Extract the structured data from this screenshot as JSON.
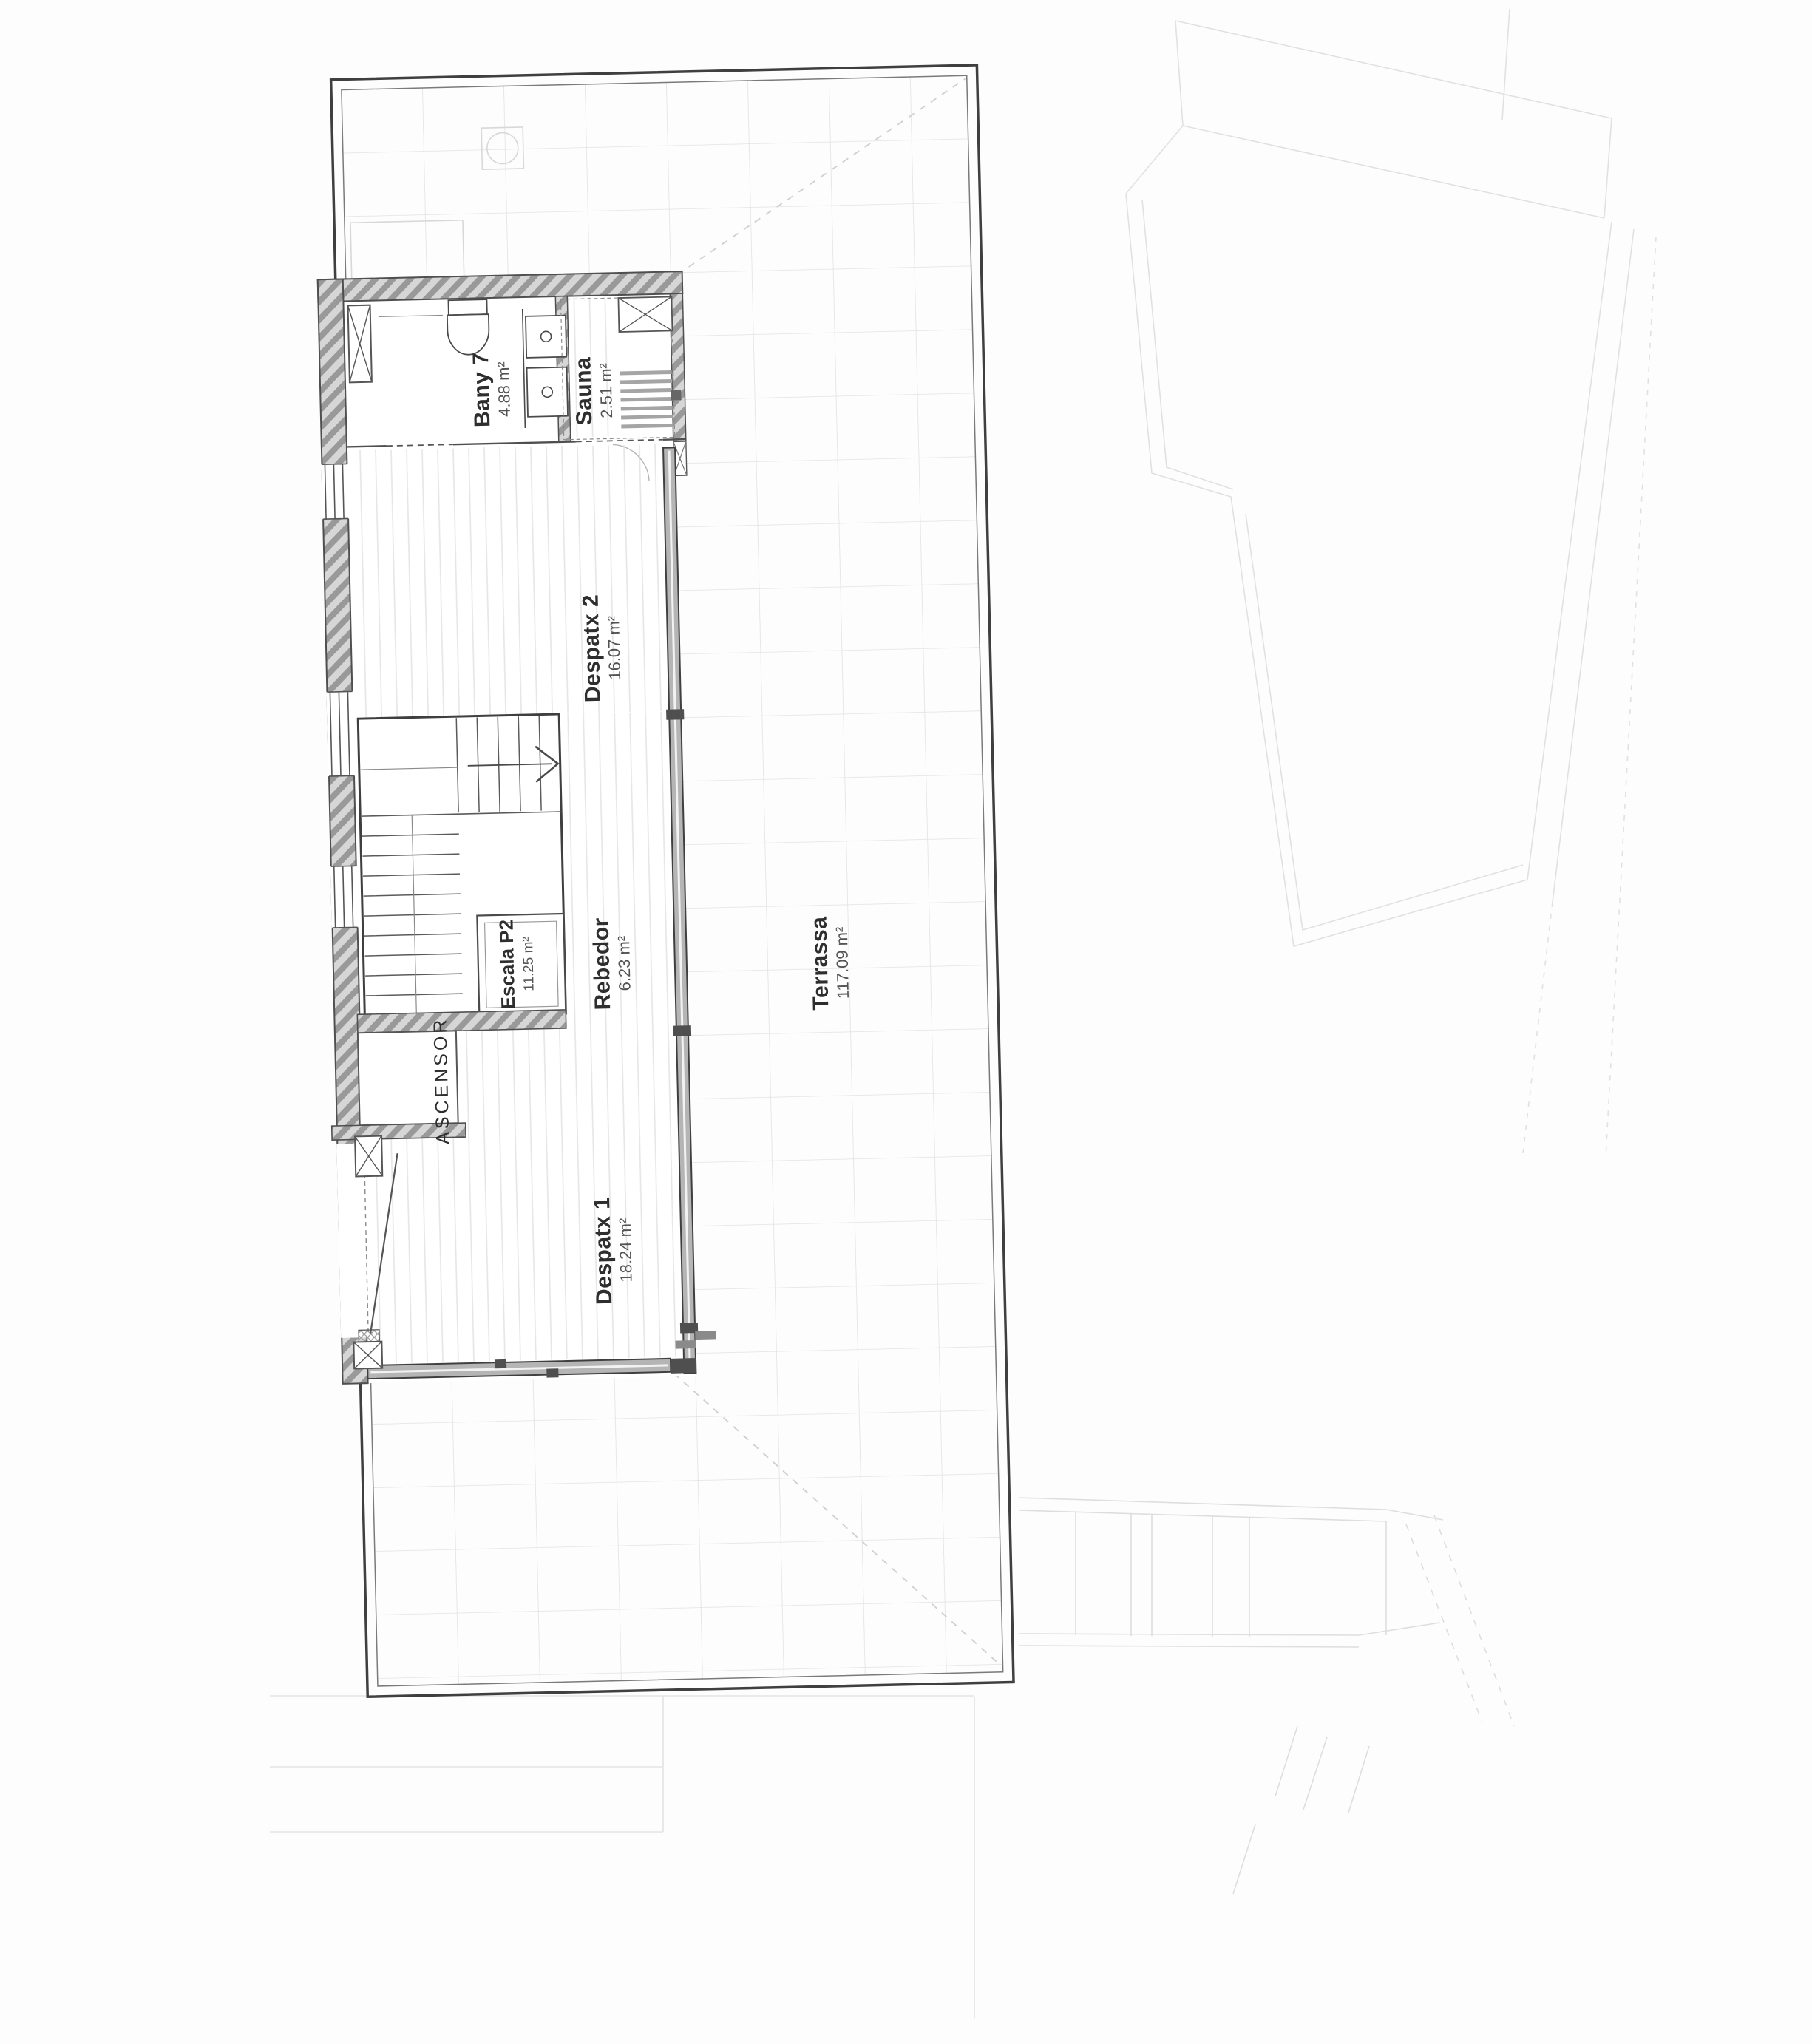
{
  "drawing": {
    "title_hint": "Planta P2 — floor plan",
    "floor_code": "P2"
  },
  "rooms": [
    {
      "id": "bany7",
      "name": "Bany 7",
      "area": "4.88 m²"
    },
    {
      "id": "sauna",
      "name": "Sauna",
      "area": "2.51 m²"
    },
    {
      "id": "despatx2",
      "name": "Despatx 2",
      "area": "16.07 m²"
    },
    {
      "id": "escala",
      "name": "Escala P2",
      "area": "11.25 m²"
    },
    {
      "id": "rebedor",
      "name": "Rebedor",
      "area": "6.23 m²"
    },
    {
      "id": "despatx1",
      "name": "Despatx 1",
      "area": "18.24 m²"
    },
    {
      "id": "terrassa",
      "name": "Terrassa",
      "area": "117.09 m²"
    },
    {
      "id": "ascensor",
      "name": "ASCENSOR",
      "area": ""
    }
  ],
  "colors": {
    "paper": "#fdfdfd",
    "line_dark": "#3f3f3f",
    "line_mid": "#8b8b8b",
    "line_faint": "#e1e1e1",
    "wall_hatch": "#d2d2d2",
    "glazing": "#b5b5b5",
    "label_text": "#2e2e2e"
  }
}
